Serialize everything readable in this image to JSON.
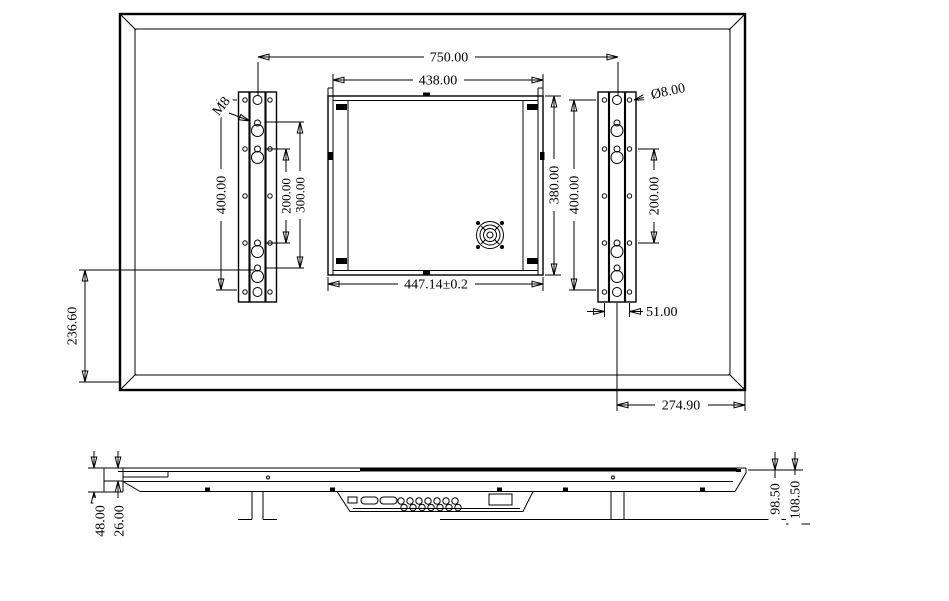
{
  "rear": {
    "mount_span": "750.00",
    "box_top_width": "438.00",
    "box_bottom_width": "447.14±0.2",
    "box_height": "380.00",
    "left_hole_span": "400.00",
    "left_pitch_small": "200.00",
    "left_pitch_large": "300.00",
    "right_hole_span": "400.00",
    "right_pitch": "200.00",
    "thread_label": "M8",
    "hole_diameter": "Ø8.00",
    "bracket_hole_width": "51.00",
    "bottom_offset": "236.60",
    "right_edge_offset": "274.90"
  },
  "side": {
    "front_thickness": "26.00",
    "panel_thickness": "48.00",
    "depth_to_mount": "98.50",
    "total_depth": "108.50"
  },
  "colors": {
    "line": "#000000",
    "background": "#ffffff"
  }
}
